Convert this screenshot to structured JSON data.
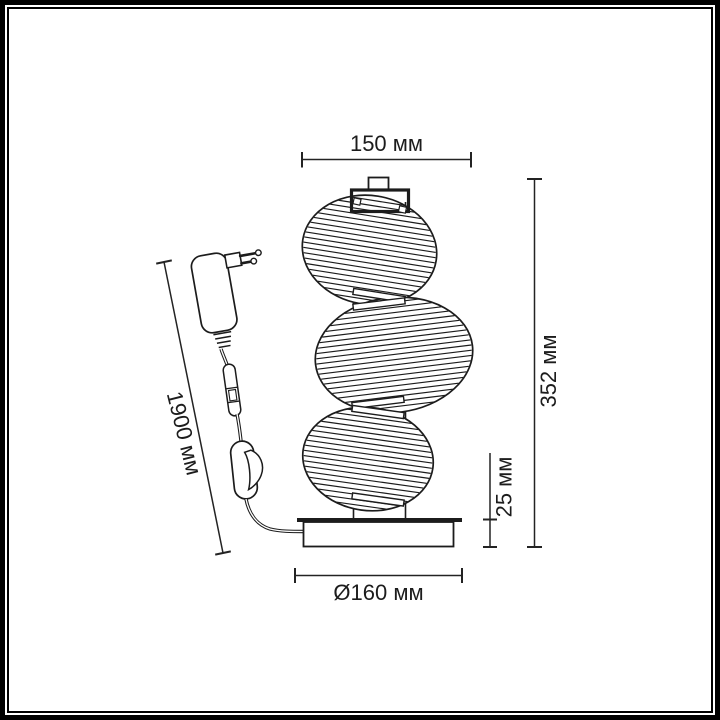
{
  "drawing": {
    "kind": "technical-dimension-diagram",
    "subject": "table lamp with three ribbed glass shades, round base, power adapter cord with inline switch"
  },
  "dimensions": {
    "top_width": "150 мм",
    "total_height": "352 мм",
    "base_height": "25 мм",
    "base_diameter": "Ø160 мм",
    "cord_length": "1900 мм"
  },
  "colors": {
    "ink": "#1c1c1c",
    "dimension_ink": "#232323",
    "background": "#ffffff",
    "frame": "#000000"
  }
}
